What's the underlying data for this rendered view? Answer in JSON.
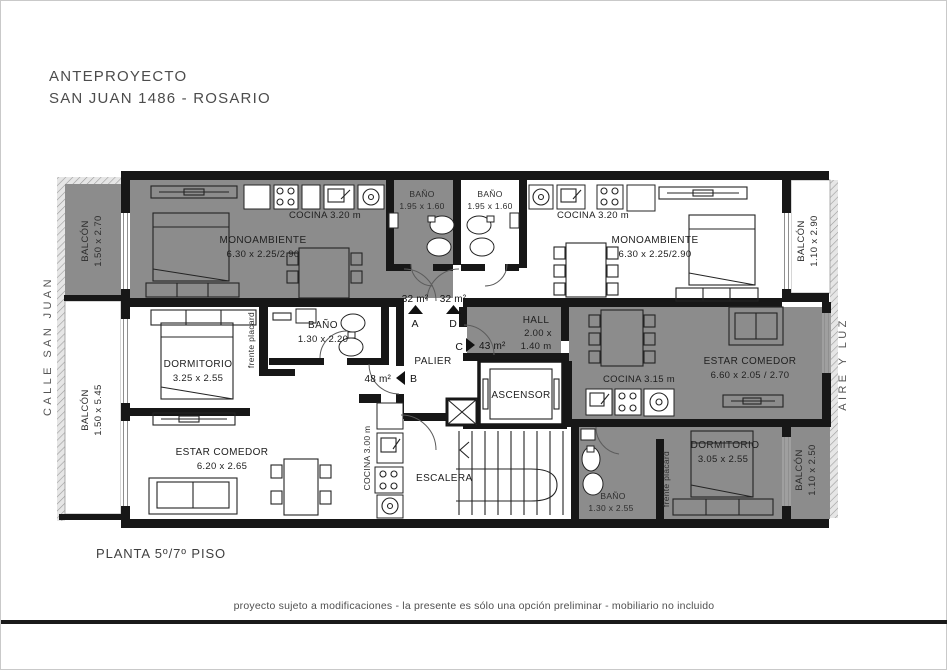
{
  "header": {
    "line1": "ANTEPROYECTO",
    "line2": "SAN JUAN 1486 - ROSARIO"
  },
  "context": {
    "street": "CALLE SAN JUAN",
    "air": "AIRE Y LUZ"
  },
  "footer": {
    "plan": "PLANTA 5º/7º PISO",
    "disclaimer": "proyecto sujeto a modificaciones - la presente es sólo una opción preliminar - mobiliario no incluido"
  },
  "colors": {
    "unit_gray": "#8c8c8c",
    "wall": "#171717",
    "paper": "#ffffff"
  },
  "balconies": {
    "top_left": {
      "name": "BALCÓN",
      "dims": "1.50 x 2.70"
    },
    "bottom_left": {
      "name": "BALCÓN",
      "dims": "1.50 x 5.45"
    },
    "top_right": {
      "name": "BALCÓN",
      "dims": "1.10 x 2.90"
    },
    "bottom_right": {
      "name": "BALCÓN",
      "dims": "1.10 x 2.50"
    }
  },
  "rooms": {
    "monoambiente_left": {
      "name": "MONOAMBIENTE",
      "dims": "6.30 x 2.25/2.90"
    },
    "monoambiente_right": {
      "name": "MONOAMBIENTE",
      "dims": "6.30 x 2.25/2.90"
    },
    "cocina_top_left": {
      "label": "COCINA 3.20 m"
    },
    "cocina_top_right": {
      "label": "COCINA 3.20 m"
    },
    "cocina_mid_right": {
      "label": "COCINA 3.15 m"
    },
    "cocina_bottom_left": {
      "label": "COCINA 3.00 m"
    },
    "bano_top_left": {
      "name": "BAÑO",
      "dims": "1.95 x 1.60"
    },
    "bano_top_right": {
      "name": "BAÑO",
      "dims": "1.95 x 1.60"
    },
    "bano_mid_left": {
      "name": "BAÑO",
      "dims": "1.30 x 2.20"
    },
    "bano_bottom_right": {
      "name": "BAÑO",
      "dims": "1.30 x 2.55"
    },
    "dormitorio_left": {
      "name": "DORMITORIO",
      "dims": "3.25 x 2.55"
    },
    "dormitorio_right": {
      "name": "DORMITORIO",
      "dims": "3.05 x 2.55"
    },
    "estar_left": {
      "name": "ESTAR COMEDOR",
      "dims": "6.20 x 2.65"
    },
    "estar_right": {
      "name": "ESTAR COMEDOR",
      "dims": "6.60 x 2.05 / 2.70"
    },
    "hall": {
      "name": "HALL",
      "dims1": "2.00 x",
      "dims2": "1.40 m"
    },
    "palier": {
      "label": "PALIER"
    },
    "ascensor": {
      "label": "ASCENSOR"
    },
    "escalera": {
      "label": "ESCALERA"
    },
    "placard_left": {
      "label": "frente placard"
    },
    "placard_right": {
      "label": "frente placard"
    }
  },
  "units": {
    "a": {
      "area": "32 m²",
      "letter": "A"
    },
    "d": {
      "area": "32 m²",
      "letter": "D"
    },
    "c": {
      "area": "43 m²",
      "letter": "C"
    },
    "b": {
      "area": "48 m²",
      "letter": "B"
    }
  }
}
